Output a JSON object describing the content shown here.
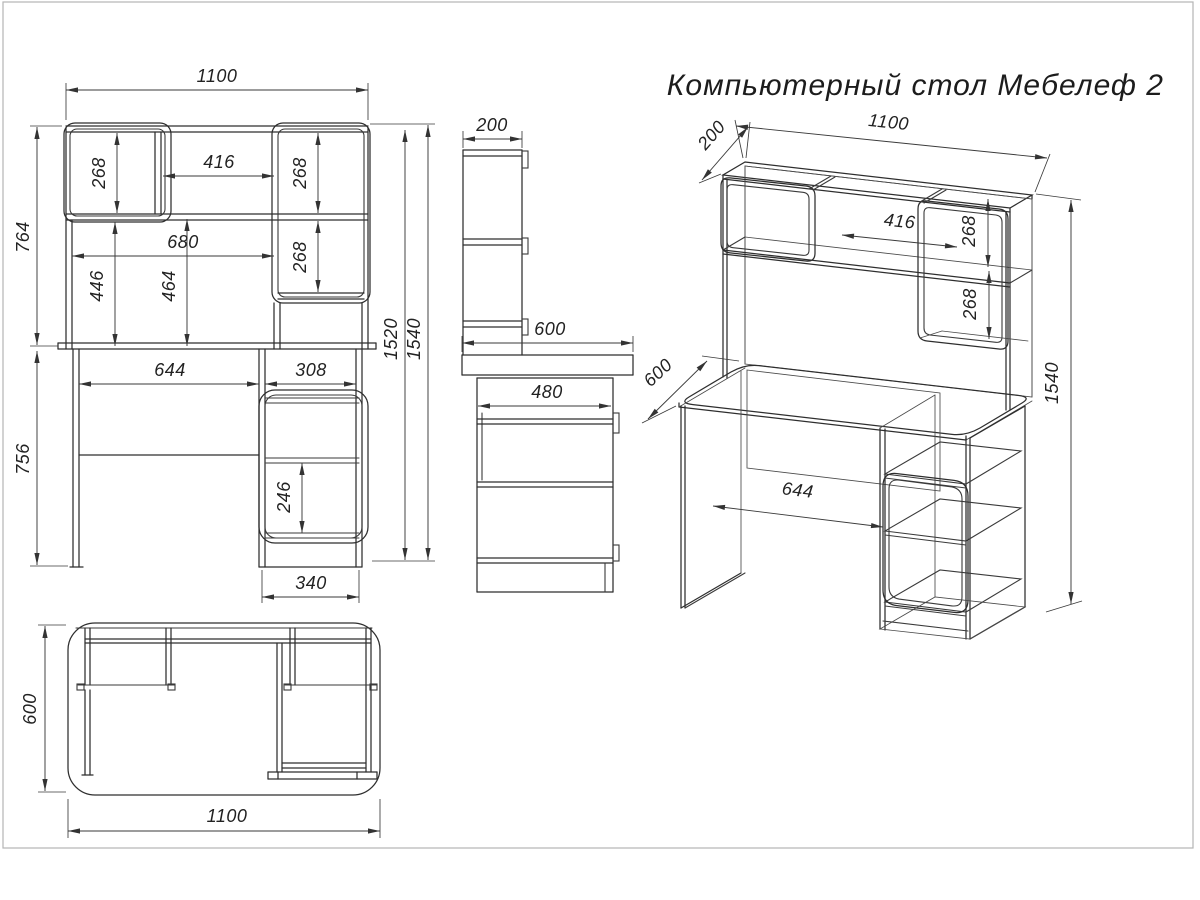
{
  "title": "Компьютерный стол Мебелеф 2",
  "views": {
    "front": {
      "dims": {
        "width": "1100",
        "hutch_height": "764",
        "base_height": "756",
        "left_shelf": "268",
        "niche_width": "416",
        "right_shelf_top": "268",
        "right_shelf_mid": "268",
        "inner_width": "680",
        "inner_left_height": "446",
        "inner_mid_height": "464",
        "height_to_top": "1520",
        "total_height": "1540",
        "knee_width": "644",
        "pedestal_inner": "308",
        "drawer_space": "246",
        "pedestal_width": "340"
      }
    },
    "side": {
      "dims": {
        "hutch_depth": "200",
        "desk_depth": "600",
        "pedestal_depth": "480"
      }
    },
    "iso": {
      "dims": {
        "hutch_depth": "200",
        "width": "1100",
        "niche_width": "416",
        "shelf_top": "268",
        "shelf_mid": "268",
        "desk_depth": "600",
        "knee_width": "644",
        "total_height": "1540"
      }
    },
    "top": {
      "dims": {
        "depth": "600",
        "width": "1100"
      }
    }
  }
}
